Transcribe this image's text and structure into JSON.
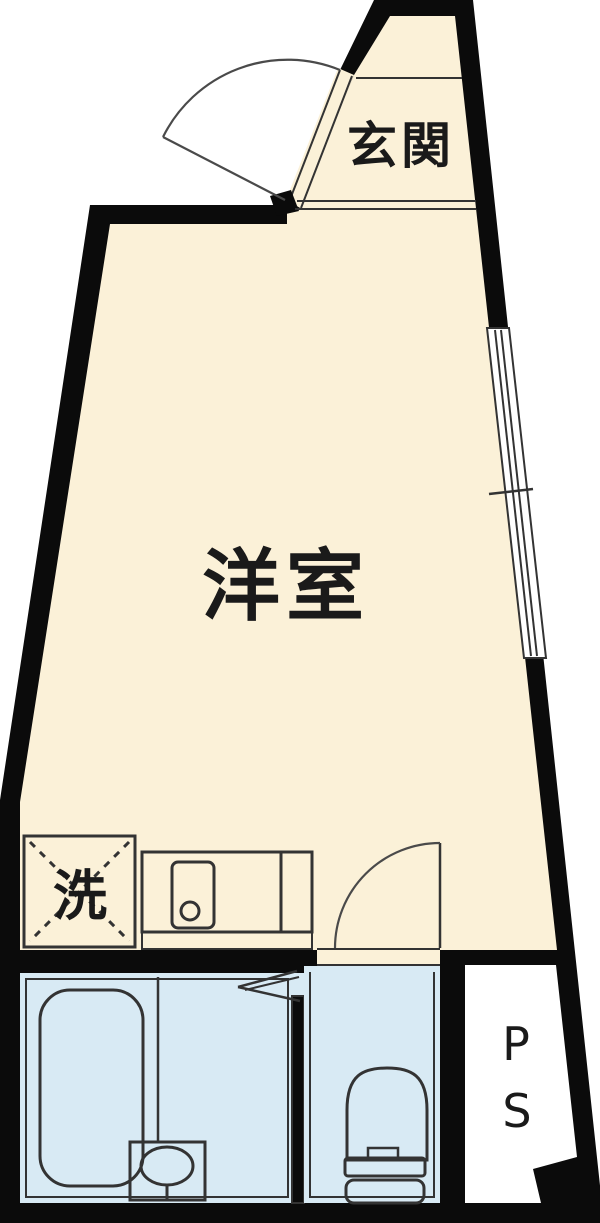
{
  "floorplan": {
    "type": "apartment-floor-plan",
    "rooms": {
      "genkan": {
        "label": "玄関"
      },
      "western_room": {
        "label": "洋室"
      },
      "laundry": {
        "label": "洗"
      },
      "pipe_space": {
        "p": "P",
        "s": "S"
      }
    },
    "colors": {
      "wall": "#0b0b0b",
      "floor": "#fbf1d8",
      "fixture": "#d8eaf4",
      "line": "#333333",
      "background": "#ffffff",
      "text": "#1a1a1a"
    }
  }
}
